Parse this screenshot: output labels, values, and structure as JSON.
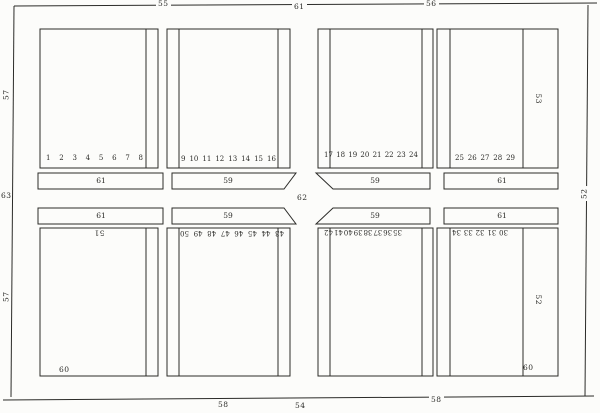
{
  "figure_labels": {
    "top_left_rail": "55",
    "top_center": "61",
    "top_right_rail": "56",
    "left_rail_upper": "57",
    "left_center": "63",
    "left_rail_lower": "57",
    "right_center": "52",
    "bottom_left_rail": "58",
    "bottom_center": "54",
    "bottom_right_rail": "58",
    "center_gap": "62",
    "top_right_column": "53",
    "bottom_right_column": "52",
    "bottom_left_panel": "51",
    "bottom_left_corner": "60",
    "bottom_right_corner": "60"
  },
  "bars": {
    "top_row": {
      "b1": "61",
      "b2": "59",
      "b3": "59",
      "b4": "61"
    },
    "bottom_row": {
      "b1": "61",
      "b2": "59",
      "b3": "59",
      "b4": "61"
    }
  },
  "number_strips": {
    "top_panel_1": [
      "1",
      "2",
      "3",
      "4",
      "5",
      "6",
      "7",
      "8"
    ],
    "top_panel_2": [
      "9",
      "10",
      "11",
      "12",
      "13",
      "14",
      "15",
      "16"
    ],
    "top_panel_3": [
      "17",
      "18",
      "19",
      "20",
      "21",
      "22",
      "23",
      "24"
    ],
    "top_panel_4": [
      "25",
      "26",
      "27",
      "28",
      "29"
    ],
    "bottom_panel_2": [
      "43",
      "44",
      "45",
      "46",
      "47",
      "48",
      "49",
      "50"
    ],
    "bottom_panel_3": [
      "35",
      "36",
      "37",
      "38",
      "39",
      "40",
      "41",
      "42"
    ],
    "bottom_panel_4": [
      "30",
      "31",
      "32",
      "33",
      "34"
    ]
  },
  "colors": {
    "ink": "#2b2b28",
    "paper": "#fcfcfa"
  }
}
